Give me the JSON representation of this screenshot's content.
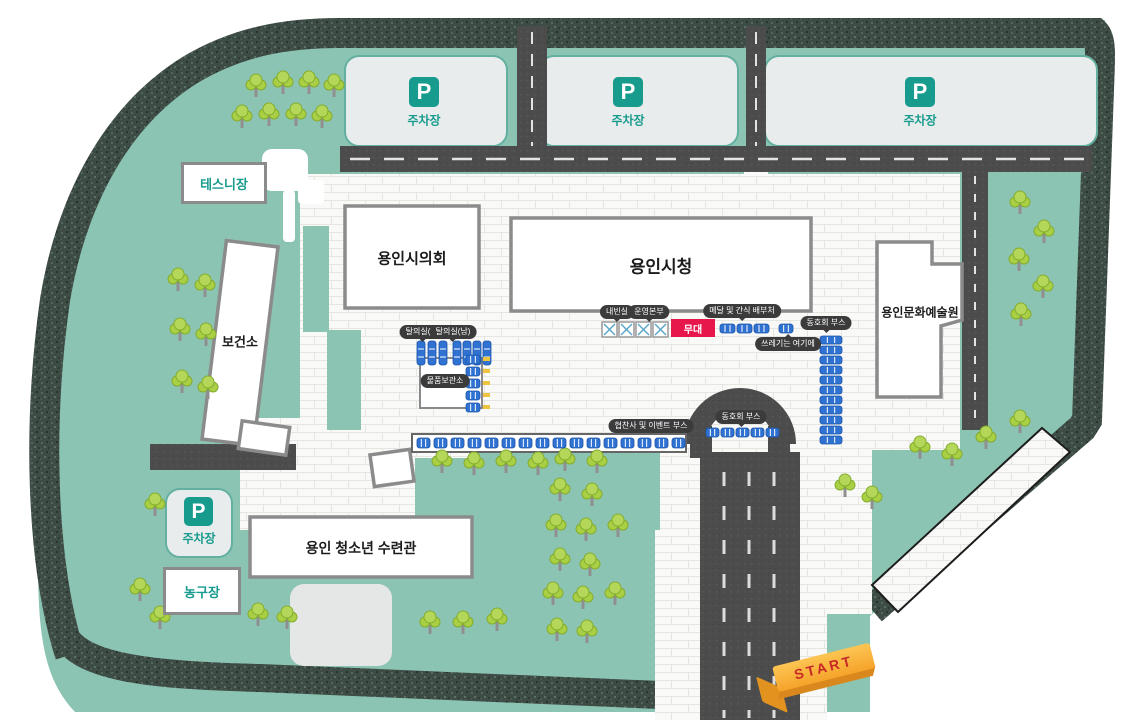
{
  "map": {
    "parking": {
      "icon": "P",
      "label": "주차장"
    },
    "areas": {
      "tennis": "테스니장",
      "basketball": "농구장",
      "health_center": "보건소",
      "city_council": "용인시의회",
      "city_hall": "용인시청",
      "culture_arts": "용인문화예술원",
      "youth_center": "용인 청소년 수련관"
    },
    "facilities": {
      "vip_room": "내빈실",
      "operation_hq": "운영본부",
      "stage": "무대",
      "medal_snack": "메달 및 간식 배부처",
      "trash_here": "쓰레기는 여기에",
      "club_booth_right": "동호회 부스",
      "club_booth_road": "동호회 부스",
      "sponsor_event_booth": "협찬사 및 이벤트 부스",
      "changing_room_w": "탈의실(여)",
      "changing_room_m": "탈의실(남)",
      "storage": "물품보관소"
    },
    "start": {
      "label": "START"
    },
    "colors": {
      "teal_accent": "#169b8d",
      "map_green": "#8cc4b3",
      "booth_blue": "#2f72d2",
      "stage_red": "#e8174b",
      "start_orange": "#f5a32a"
    }
  }
}
